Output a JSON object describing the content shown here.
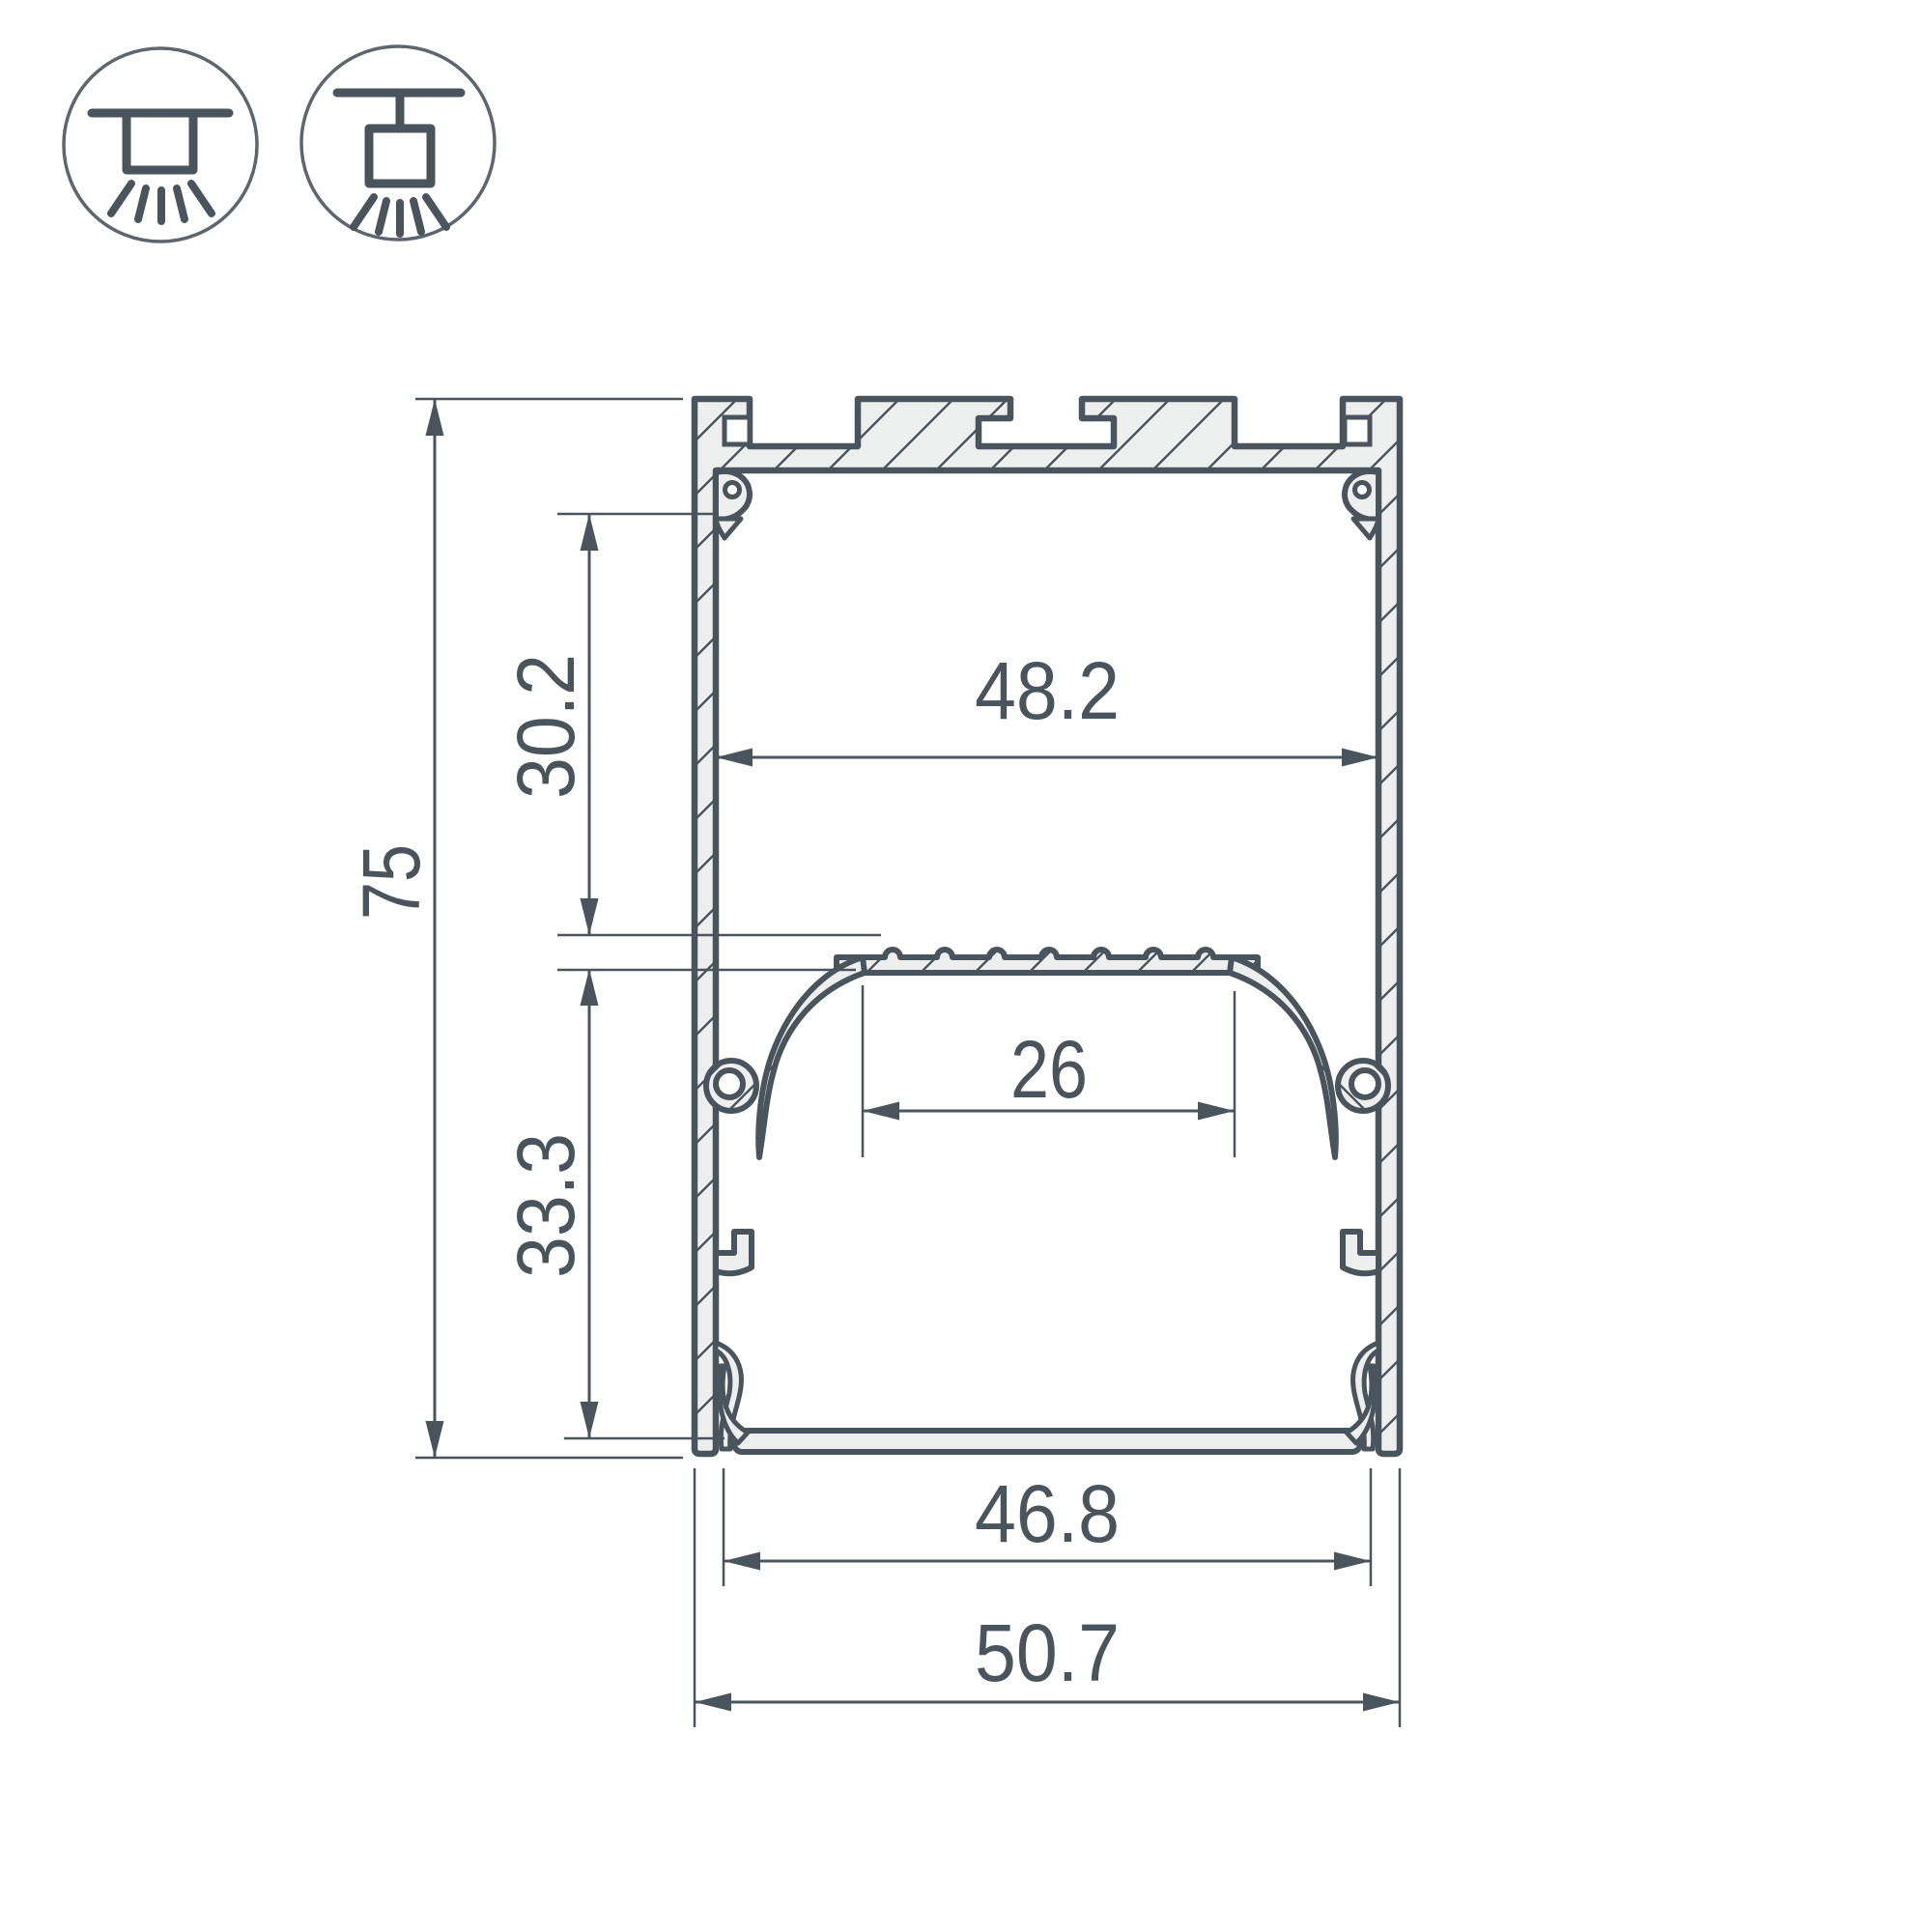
{
  "drawing": {
    "type": "profile-cross-section-technical-drawing",
    "dimensions": {
      "overall_height": {
        "value": "75",
        "orientation": "vertical"
      },
      "upper_chamber_height": {
        "value": "30.2",
        "orientation": "vertical"
      },
      "lower_chamber_height": {
        "value": "33.3",
        "orientation": "vertical"
      },
      "inner_width": {
        "value": "48.2",
        "orientation": "horizontal"
      },
      "led_shelf_width": {
        "value": "26",
        "orientation": "horizontal"
      },
      "diffuser_width": {
        "value": "46.8",
        "orientation": "horizontal"
      },
      "overall_width": {
        "value": "50.7",
        "orientation": "horizontal"
      }
    },
    "icons": [
      {
        "name": "surface-ceiling-mount-icon"
      },
      {
        "name": "pendant-suspension-mount-icon"
      }
    ],
    "colors": {
      "line": "#4a545c",
      "icon_circle": "#5d666e",
      "aluminum_fill": "#edeeee",
      "background": "#ffffff"
    }
  }
}
